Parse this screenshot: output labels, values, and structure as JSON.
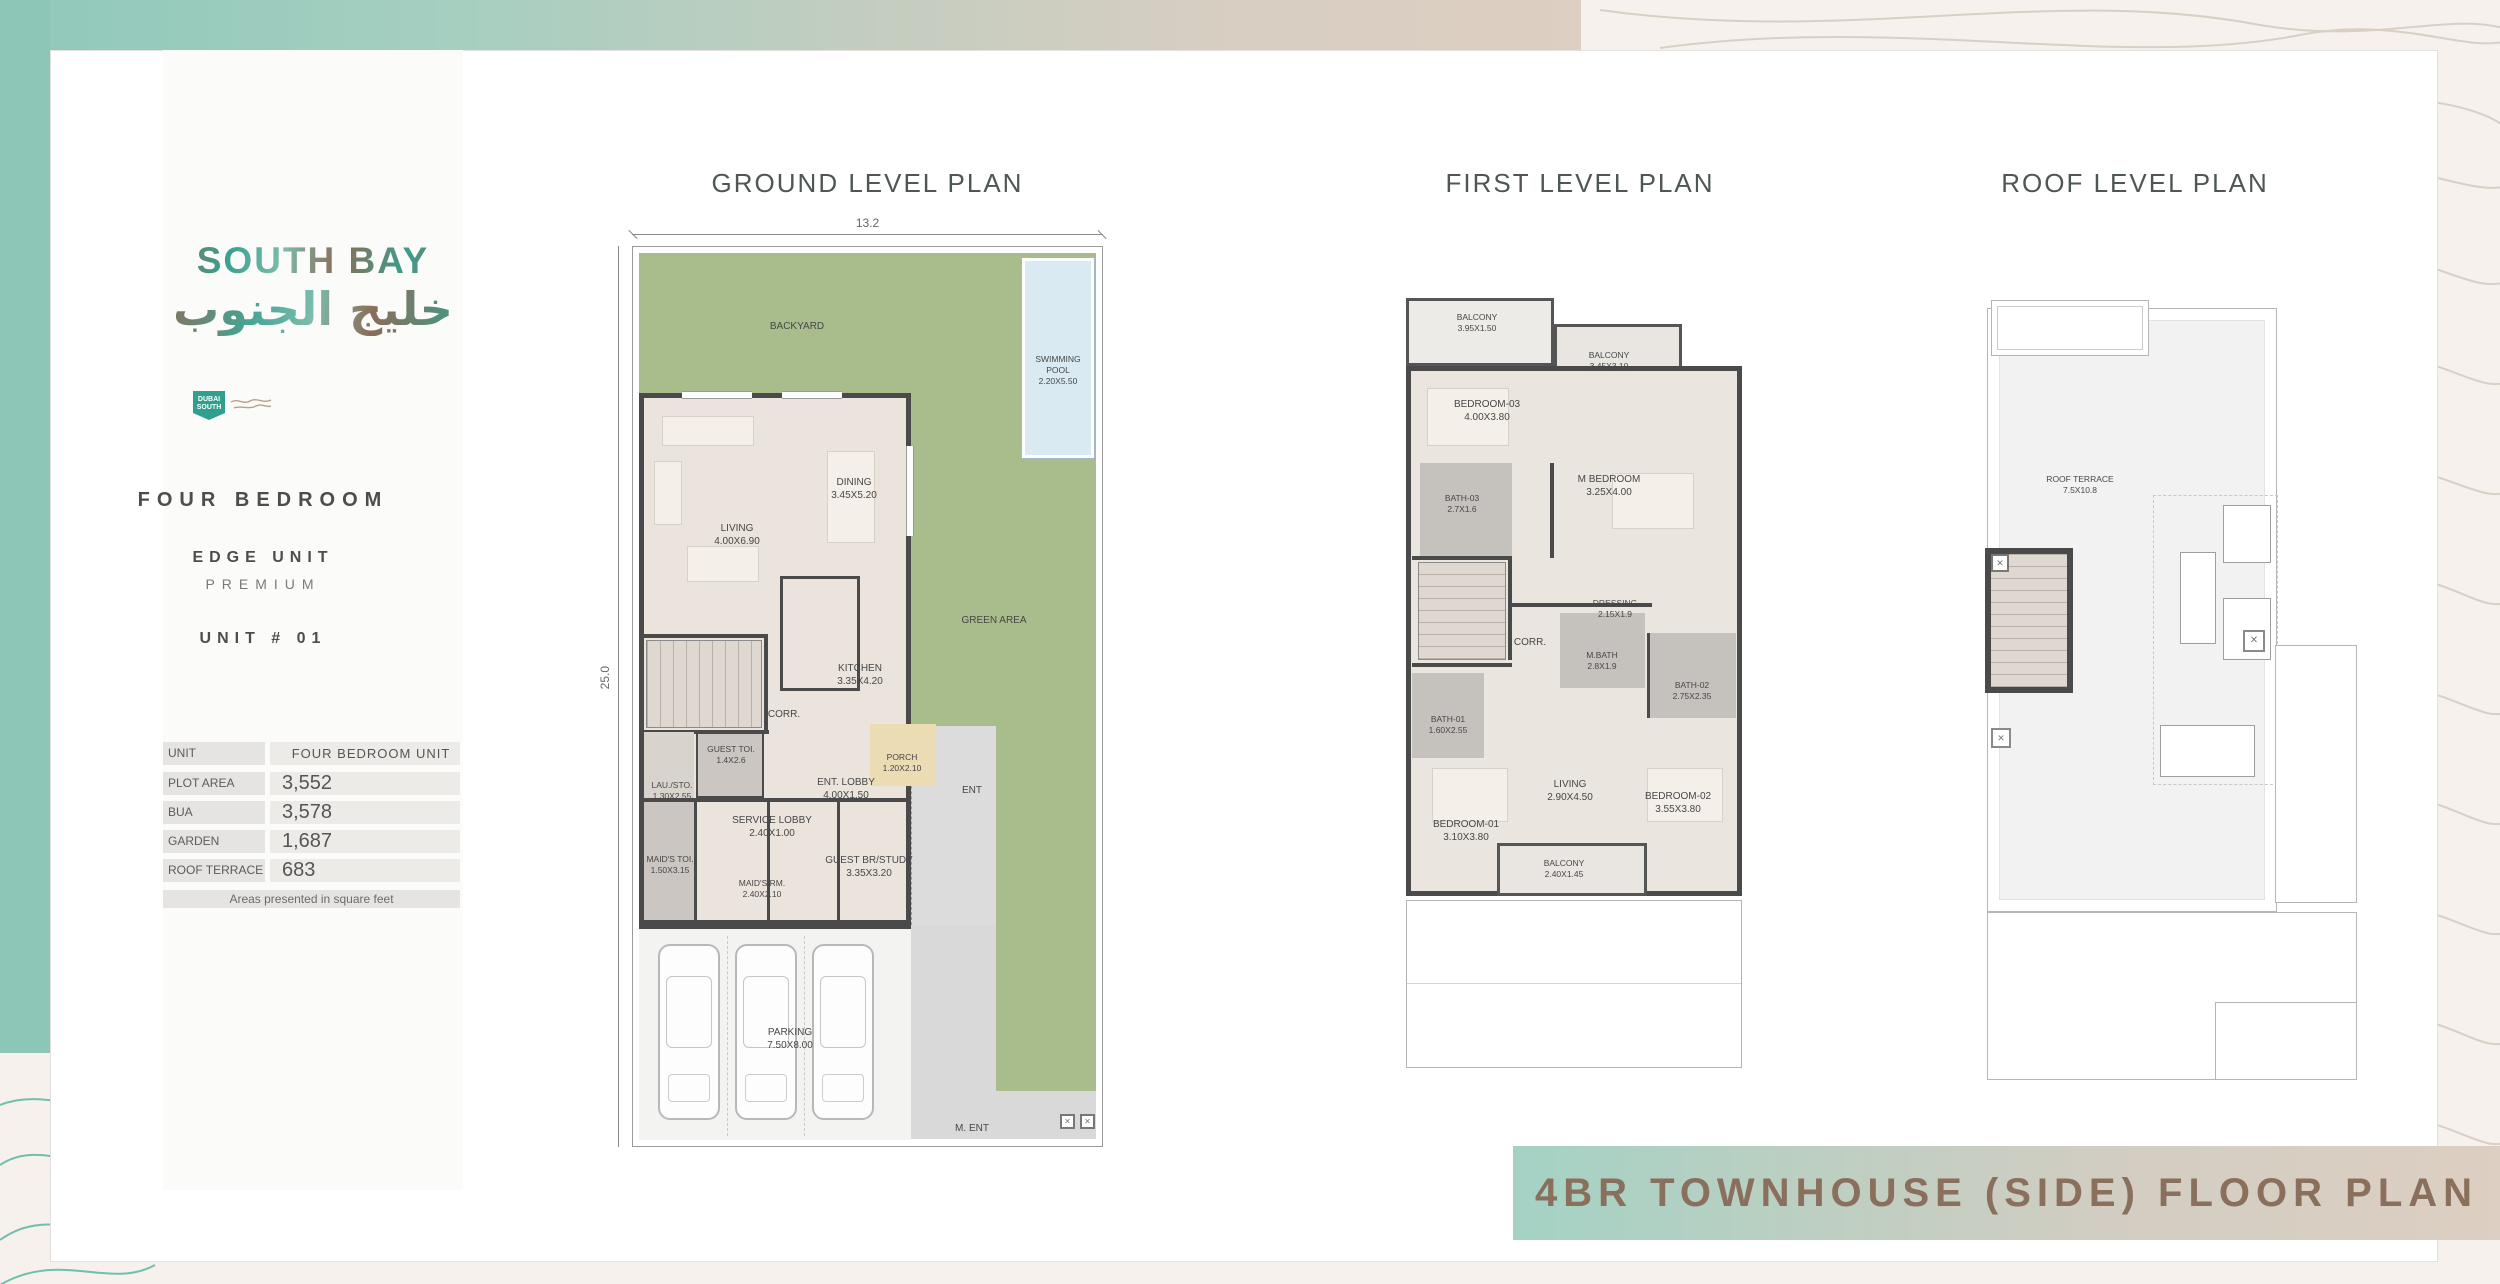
{
  "colors": {
    "accent_teal": "#8dc6b7",
    "accent_beige": "#ddcfc2",
    "banner_text": "#8a6f5d",
    "garden_green": "#a9bc8b",
    "pool_blue": "#d9eaf3",
    "wall": "#4a4a4a"
  },
  "sidebar": {
    "logo_en": "SOUTH BAY",
    "logo_ar": "خليج الجنوب",
    "badge": "DUBAI SOUTH",
    "type": "FOUR BEDROOM",
    "unit_class": "EDGE UNIT",
    "tier": "PREMIUM",
    "unit_no": "UNIT # 01",
    "table": {
      "rows": [
        {
          "label": "UNIT",
          "value": "FOUR BEDROOM UNIT"
        },
        {
          "label": "PLOT AREA",
          "value": "3,552"
        },
        {
          "label": "BUA",
          "value": "3,578"
        },
        {
          "label": "GARDEN",
          "value": "1,687"
        },
        {
          "label": "ROOF TERRACE",
          "value": "683"
        }
      ],
      "footnote": "Areas presented in square feet"
    }
  },
  "plans": {
    "ground": {
      "title": "GROUND LEVEL PLAN",
      "dim_width": "13.2",
      "dim_height": "25.0",
      "rooms": [
        {
          "name": "BACKYARD",
          "size": ""
        },
        {
          "name": "SWIMMING POOL",
          "size": "2.20X5.50"
        },
        {
          "name": "DINING",
          "size": "3.45X5.20"
        },
        {
          "name": "LIVING",
          "size": "4.00X6.90"
        },
        {
          "name": "GREEN AREA",
          "size": ""
        },
        {
          "name": "KITCHEN",
          "size": "3.35X4.20"
        },
        {
          "name": "CORR.",
          "size": ""
        },
        {
          "name": "GUEST TOI.",
          "size": "1.4X2.6"
        },
        {
          "name": "ENT. LOBBY",
          "size": "4.00X1.50"
        },
        {
          "name": "PORCH",
          "size": "1.20X2.10"
        },
        {
          "name": "ENT",
          "size": ""
        },
        {
          "name": "LAU./STO.",
          "size": "1.30X2.55"
        },
        {
          "name": "SERVICE LOBBY",
          "size": "2.40X1.00"
        },
        {
          "name": "MAID'S TOI.",
          "size": "1.50X3.15"
        },
        {
          "name": "MAID'S RM.",
          "size": "2.40X2.10"
        },
        {
          "name": "GUEST BR/STUDY",
          "size": "3.35X3.20"
        },
        {
          "name": "PARKING",
          "size": "7.50X8.00"
        },
        {
          "name": "M. ENT",
          "size": ""
        }
      ]
    },
    "first": {
      "title": "FIRST LEVEL PLAN",
      "rooms": [
        {
          "name": "BALCONY",
          "size": "3.95X1.50"
        },
        {
          "name": "BALCONY",
          "size": "3.45X3.10"
        },
        {
          "name": "BEDROOM-03",
          "size": "4.00X3.80"
        },
        {
          "name": "M BEDROOM",
          "size": "3.25X4.00"
        },
        {
          "name": "BATH-03",
          "size": "2.7X1.6"
        },
        {
          "name": "DRESSING",
          "size": "2.15X1.9"
        },
        {
          "name": "CORR.",
          "size": ""
        },
        {
          "name": "M.BATH",
          "size": "2.8X1.9"
        },
        {
          "name": "BATH-02",
          "size": "2.75X2.35"
        },
        {
          "name": "BATH-01",
          "size": "1.60X2.55"
        },
        {
          "name": "LIVING",
          "size": "2.90X4.50"
        },
        {
          "name": "BEDROOM-01",
          "size": "3.10X3.80"
        },
        {
          "name": "BEDROOM-02",
          "size": "3.55X3.80"
        },
        {
          "name": "BALCONY",
          "size": "2.40X1.45"
        }
      ]
    },
    "roof": {
      "title": "ROOF LEVEL PLAN",
      "rooms": [
        {
          "name": "ROOF TERRACE",
          "size": "7.5X10.8"
        }
      ]
    }
  },
  "banner": {
    "text": "4BR TOWNHOUSE (SIDE) FLOOR PLAN"
  }
}
